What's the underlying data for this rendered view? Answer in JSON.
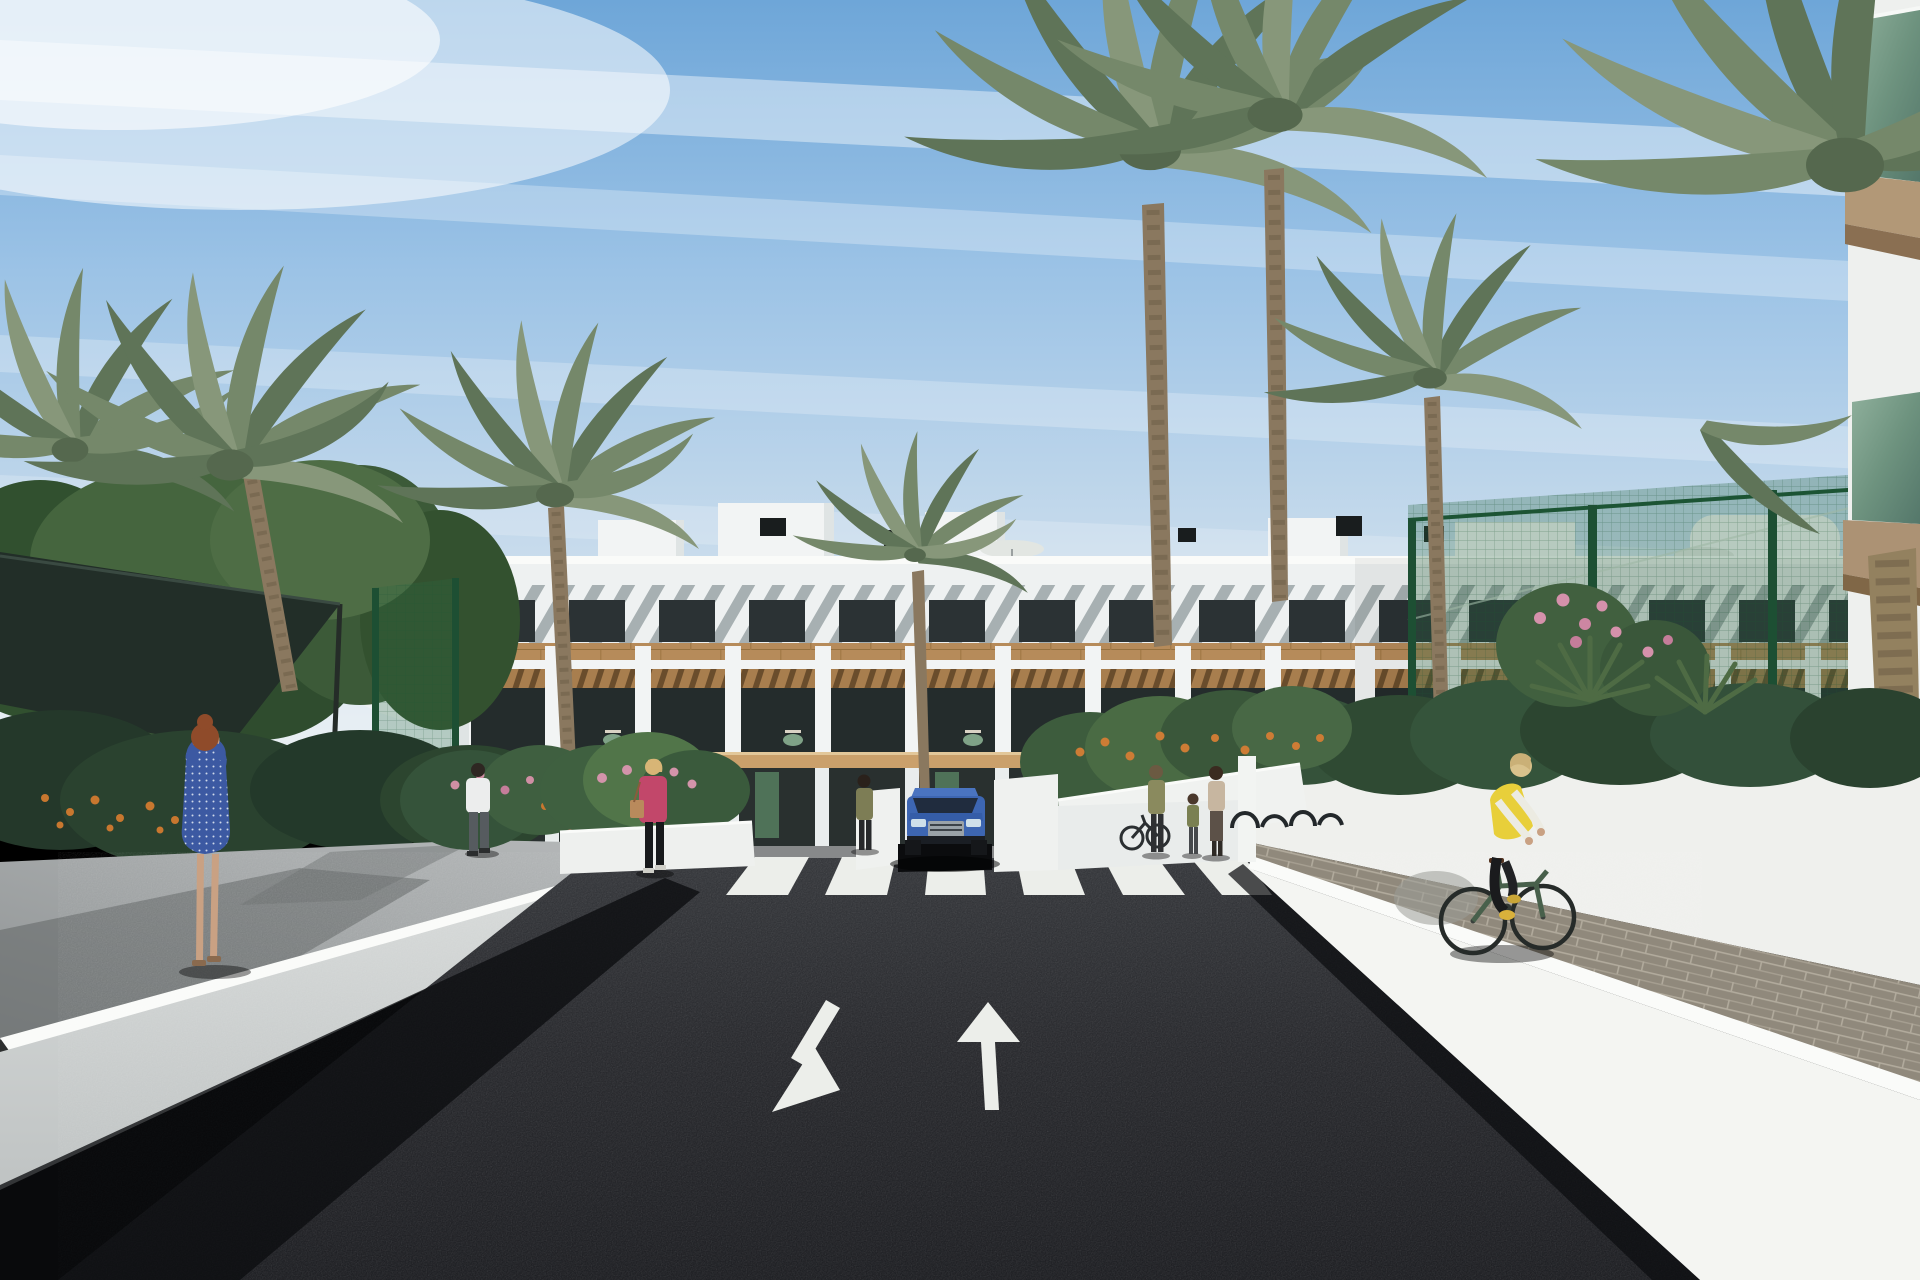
{
  "scene": {
    "type": "architectural-render",
    "subject": "3D rendering of a white Mediterranean apartment complex with wood-clad balconies, palm-lined gardens, an entrance road with underground parking ramp, a zebra crosswalk, painted lane arrows, pedestrians and a cyclist under a streaked blue sky",
    "objects": [
      "sky",
      "cloud-streaks",
      "apartment-building",
      "rooftop-bulkheads",
      "roof-vents",
      "roof-umbrellas",
      "brise-soleil-band",
      "top-floor-windows",
      "wood-cladding-band",
      "balcony-openings",
      "pergola-strips",
      "ground-floor-doors",
      "foreground-corner-building",
      "glass-balconies",
      "green-mesh-fence",
      "shade-sail",
      "palm-trees",
      "fan-palms",
      "tree-cluster",
      "garden-planters",
      "orange-flowers",
      "pink-flowers",
      "left-sidewalk",
      "left-retaining-wall",
      "road",
      "crosswalk",
      "lane-arrow-down",
      "lane-arrow-up",
      "entrance-ramp-walls",
      "blue-suv",
      "gate-pillar",
      "bike-racks",
      "parked-bike",
      "redhead-woman",
      "man-white-shirt",
      "woman-pink-jacket",
      "woman-olive",
      "woman-bag",
      "woman-floral",
      "child",
      "balcony-people",
      "cyclist",
      "paver-sidewalk",
      "right-retaining-wall",
      "right-background-wall"
    ]
  },
  "palette": {
    "sky_top": "#6ea6d8",
    "sky_mid": "#9cc3e6",
    "sky_haze": "#e9eff3",
    "building_white": "#f2f4f4",
    "slat_gray": "#a7b0b2",
    "window_dark": "#2b3234",
    "wood_cladding": "#b68b5a",
    "pergola_wood": "#a87e4e",
    "balcony_floor": "#caa06b",
    "foliage_dark": "#2f4a30",
    "foliage_light": "#5d7a50",
    "palm_frond": "#75886a",
    "palm_trunk": "#8a785f",
    "fence_green": "#2d6b46",
    "glass_green": "#7ea08e",
    "wall_sunlit": "#f4f5f2",
    "wall_shaded": "#cfd3d2",
    "sidewalk_gray": "#a6aaaa",
    "paver_tan": "#90897c",
    "asphalt": "#2a2b2f",
    "road_marking": "#eceeea",
    "car_blue": "#3d66b2",
    "vest_yellow": "#e8cf3a",
    "jacket_pink": "#c2476a",
    "dress_blue": "#3c59a2",
    "skin": "#c9a183",
    "shade_sail": "#222e28"
  }
}
